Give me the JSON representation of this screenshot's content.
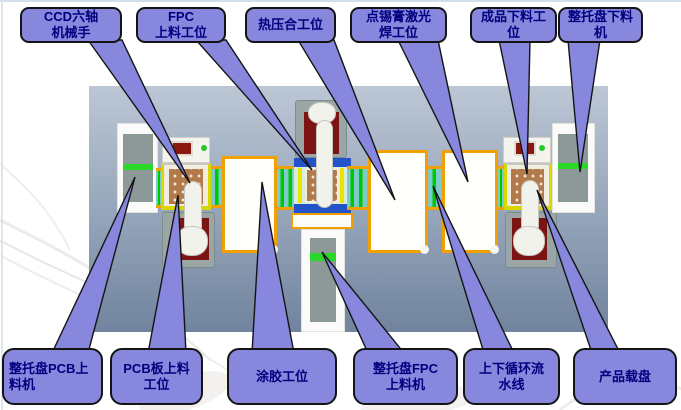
{
  "palette": {
    "callout-fill": "#8687dd",
    "callout-border": "#141414",
    "callout-text": "#00007f",
    "machine-top": "#bcc7d5",
    "machine-bottom": "#71839e",
    "orange": "#f0a000",
    "green": "#00c800",
    "teal": "#7ecaca",
    "tray": "#b27a4a",
    "plate": "#9aa6a6",
    "red-pad": "#7c1414",
    "cabinet-gray": "#8d9898",
    "stripe-green": "#2ad82a",
    "panel-white": "#fffffc",
    "robot-white": "#f2f2ec"
  },
  "diagram": {
    "top_labels": [
      {
        "id": "ccd-six-axis-robot",
        "text": "CCD六轴\n机械手"
      },
      {
        "id": "fpc-loading-station",
        "text": "FPC\n上料工位"
      },
      {
        "id": "hot-press-station",
        "text": "热压合工位"
      },
      {
        "id": "solder-paste-laser-welding-station",
        "text": "点锡膏激光\n焊工位"
      },
      {
        "id": "finished-product-unloading-station",
        "text": "成品下料工\n位"
      },
      {
        "id": "tray-unloading-machine",
        "text": "整托盘下料\n机"
      }
    ],
    "bottom_labels": [
      {
        "id": "pcb-tray-loading-machine",
        "text": "整托盘PCB上\n料机"
      },
      {
        "id": "pcb-loading-station",
        "text": "PCB板上料\n工位"
      },
      {
        "id": "glue-coating-station",
        "text": "涂胶工位"
      },
      {
        "id": "fpc-tray-loading-machine",
        "text": "整托盘FPC\n上料机"
      },
      {
        "id": "updown-circulating-conveyor",
        "text": "上下循环流\n水线"
      },
      {
        "id": "product-carrier-tray",
        "text": "产品载盘"
      }
    ]
  }
}
